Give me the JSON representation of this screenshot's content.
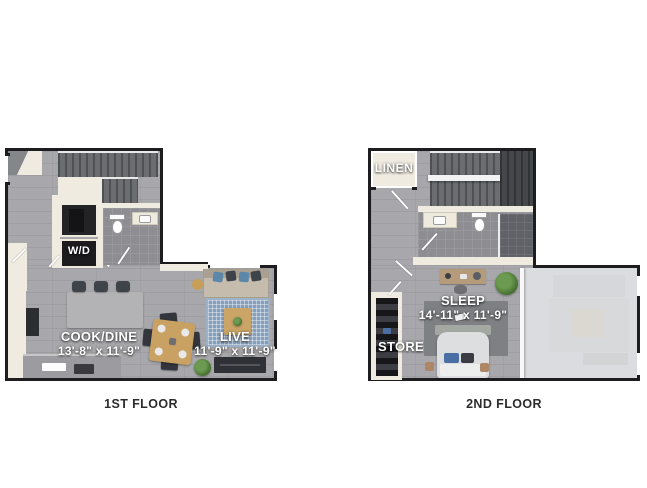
{
  "colors": {
    "page_bg": "#ffffff",
    "wall_black": "#1d1d1f",
    "wall_cream": "#f0ebe1",
    "floor_grey": "#a8a8ac",
    "floor_bath": "#8e8e92",
    "closet_dark": "#232326",
    "rug_blue": "#86a0bc",
    "wood": "#c9a263",
    "caption_grey": "#2c2c2c",
    "ghost_grey": "#d0d1d4"
  },
  "floor1": {
    "caption": "1ST FLOOR",
    "wd_label": "W/D",
    "cook_dine": {
      "name": "COOK/DINE",
      "dims": "13'-8\" x 11'-9\""
    },
    "live": {
      "name": "LIVE",
      "dims": "11'-9\" x 11'-9\""
    }
  },
  "floor2": {
    "caption": "2ND FLOOR",
    "linen_label": "LINEN",
    "store_label": "STORE",
    "sleep": {
      "name": "SLEEP",
      "dims": "14'-11\" x 11'-9\""
    }
  }
}
